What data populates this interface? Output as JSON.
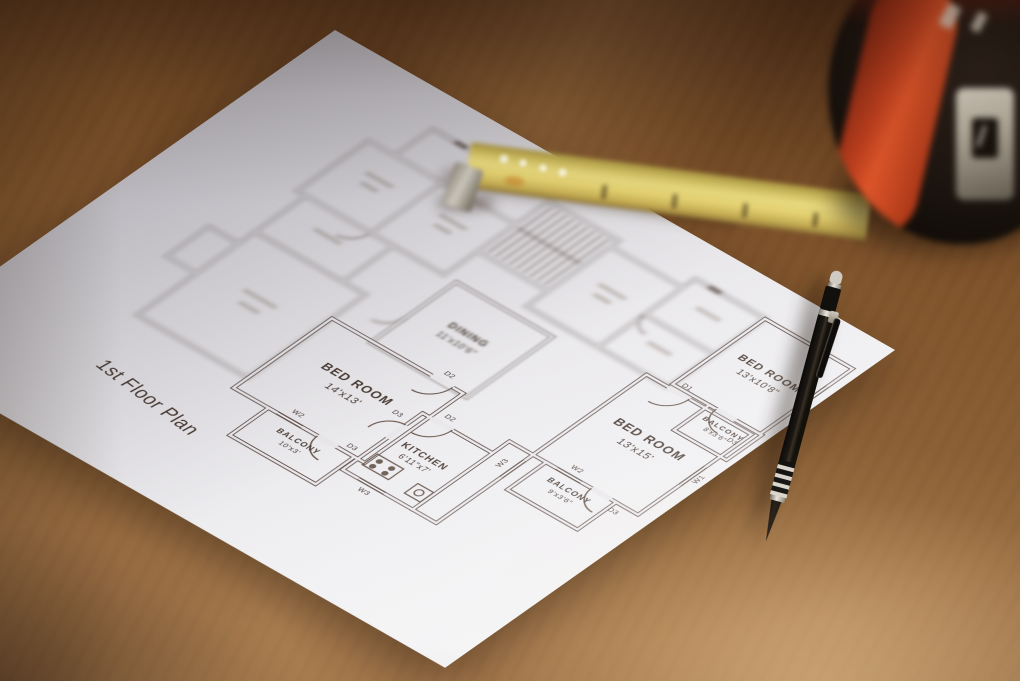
{
  "floor_plan": {
    "title": "1st Floor Plan",
    "rooms": [
      {
        "name": "BED ROOM",
        "dims": "14'x13'"
      },
      {
        "name": "KITCHEN",
        "dims": "6'11\"x7'"
      },
      {
        "name": "DINING",
        "dims": "11'x10'6\""
      },
      {
        "name": "BED ROOM",
        "dims": "13'x15'"
      },
      {
        "name": "BED ROOM",
        "dims": "13'x10'8\""
      },
      {
        "name": "BALCONY",
        "dims": "10'x3'"
      },
      {
        "name": "BALCONY",
        "dims": "9'x3'6\""
      },
      {
        "name": "BALCONY",
        "dims": "8'x3'6\""
      }
    ],
    "markers": {
      "door1": "D1",
      "door2": "D2",
      "door3": "D3",
      "window1": "W1",
      "window2": "W2",
      "window3": "W3"
    }
  },
  "colors": {
    "paper": "#eae8eb",
    "ink": "#5d4e45",
    "wood_dark": "#5a3a20",
    "wood_light": "#b78d5c",
    "tape_blade": "#ddca6d",
    "tape_body": "#17110c",
    "tape_accent": "#c7431f",
    "pencil": "#141009"
  }
}
